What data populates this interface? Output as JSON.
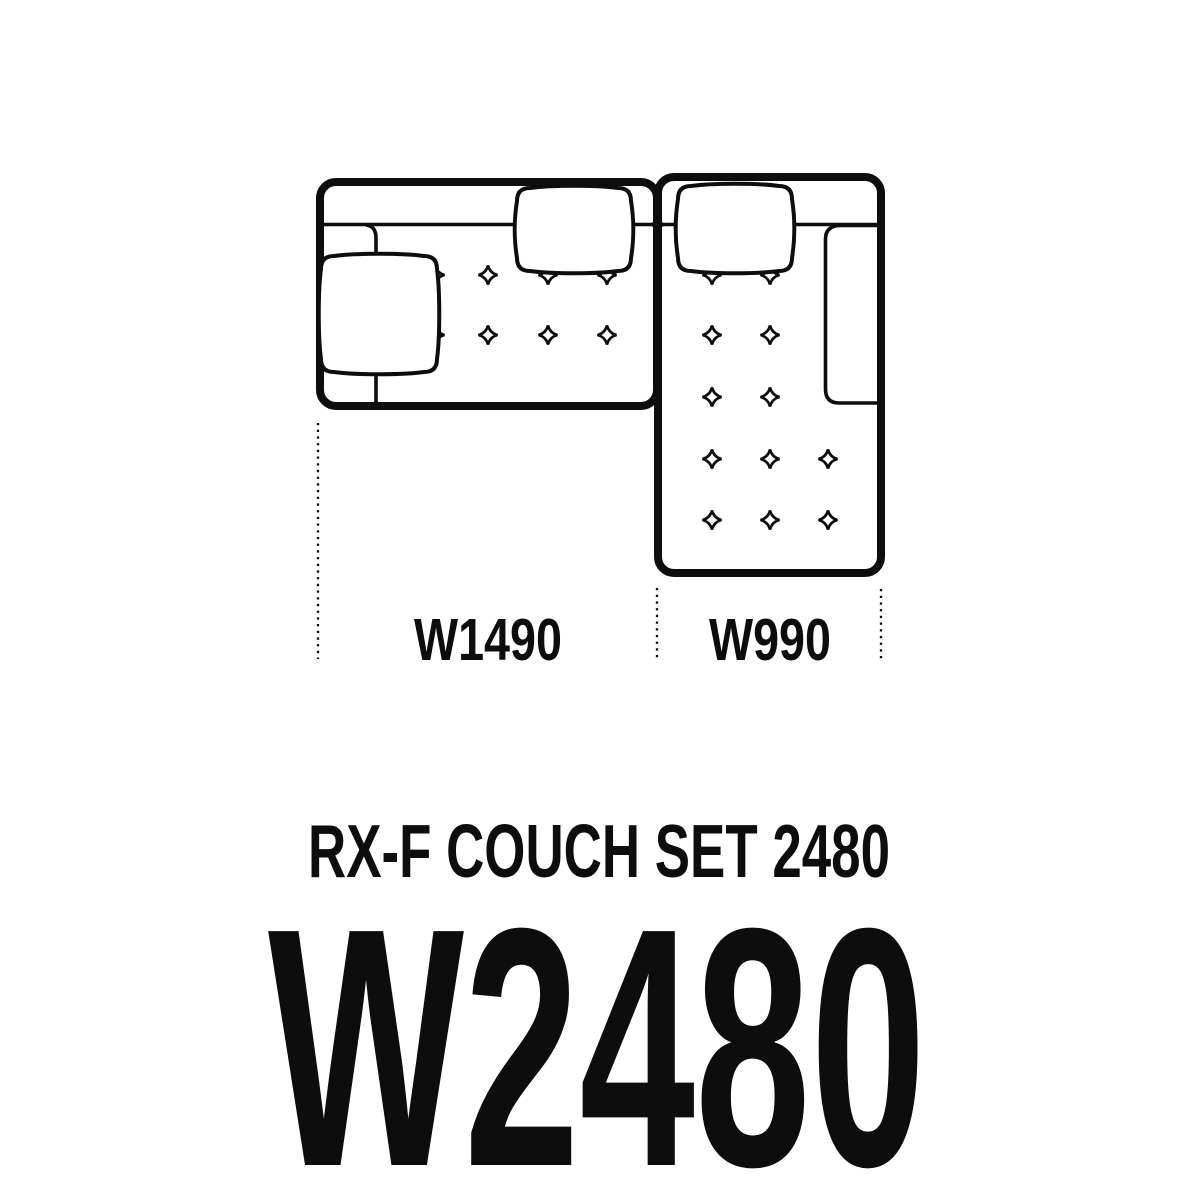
{
  "colors": {
    "background": "#ffffff",
    "line": "#0d0d0d"
  },
  "diagram": {
    "kind": "couch-set-floor-plan",
    "section_widths": [
      "W1490",
      "W990"
    ],
    "title": "RX-F COUCH SET 2480",
    "total_width": "W2480"
  }
}
